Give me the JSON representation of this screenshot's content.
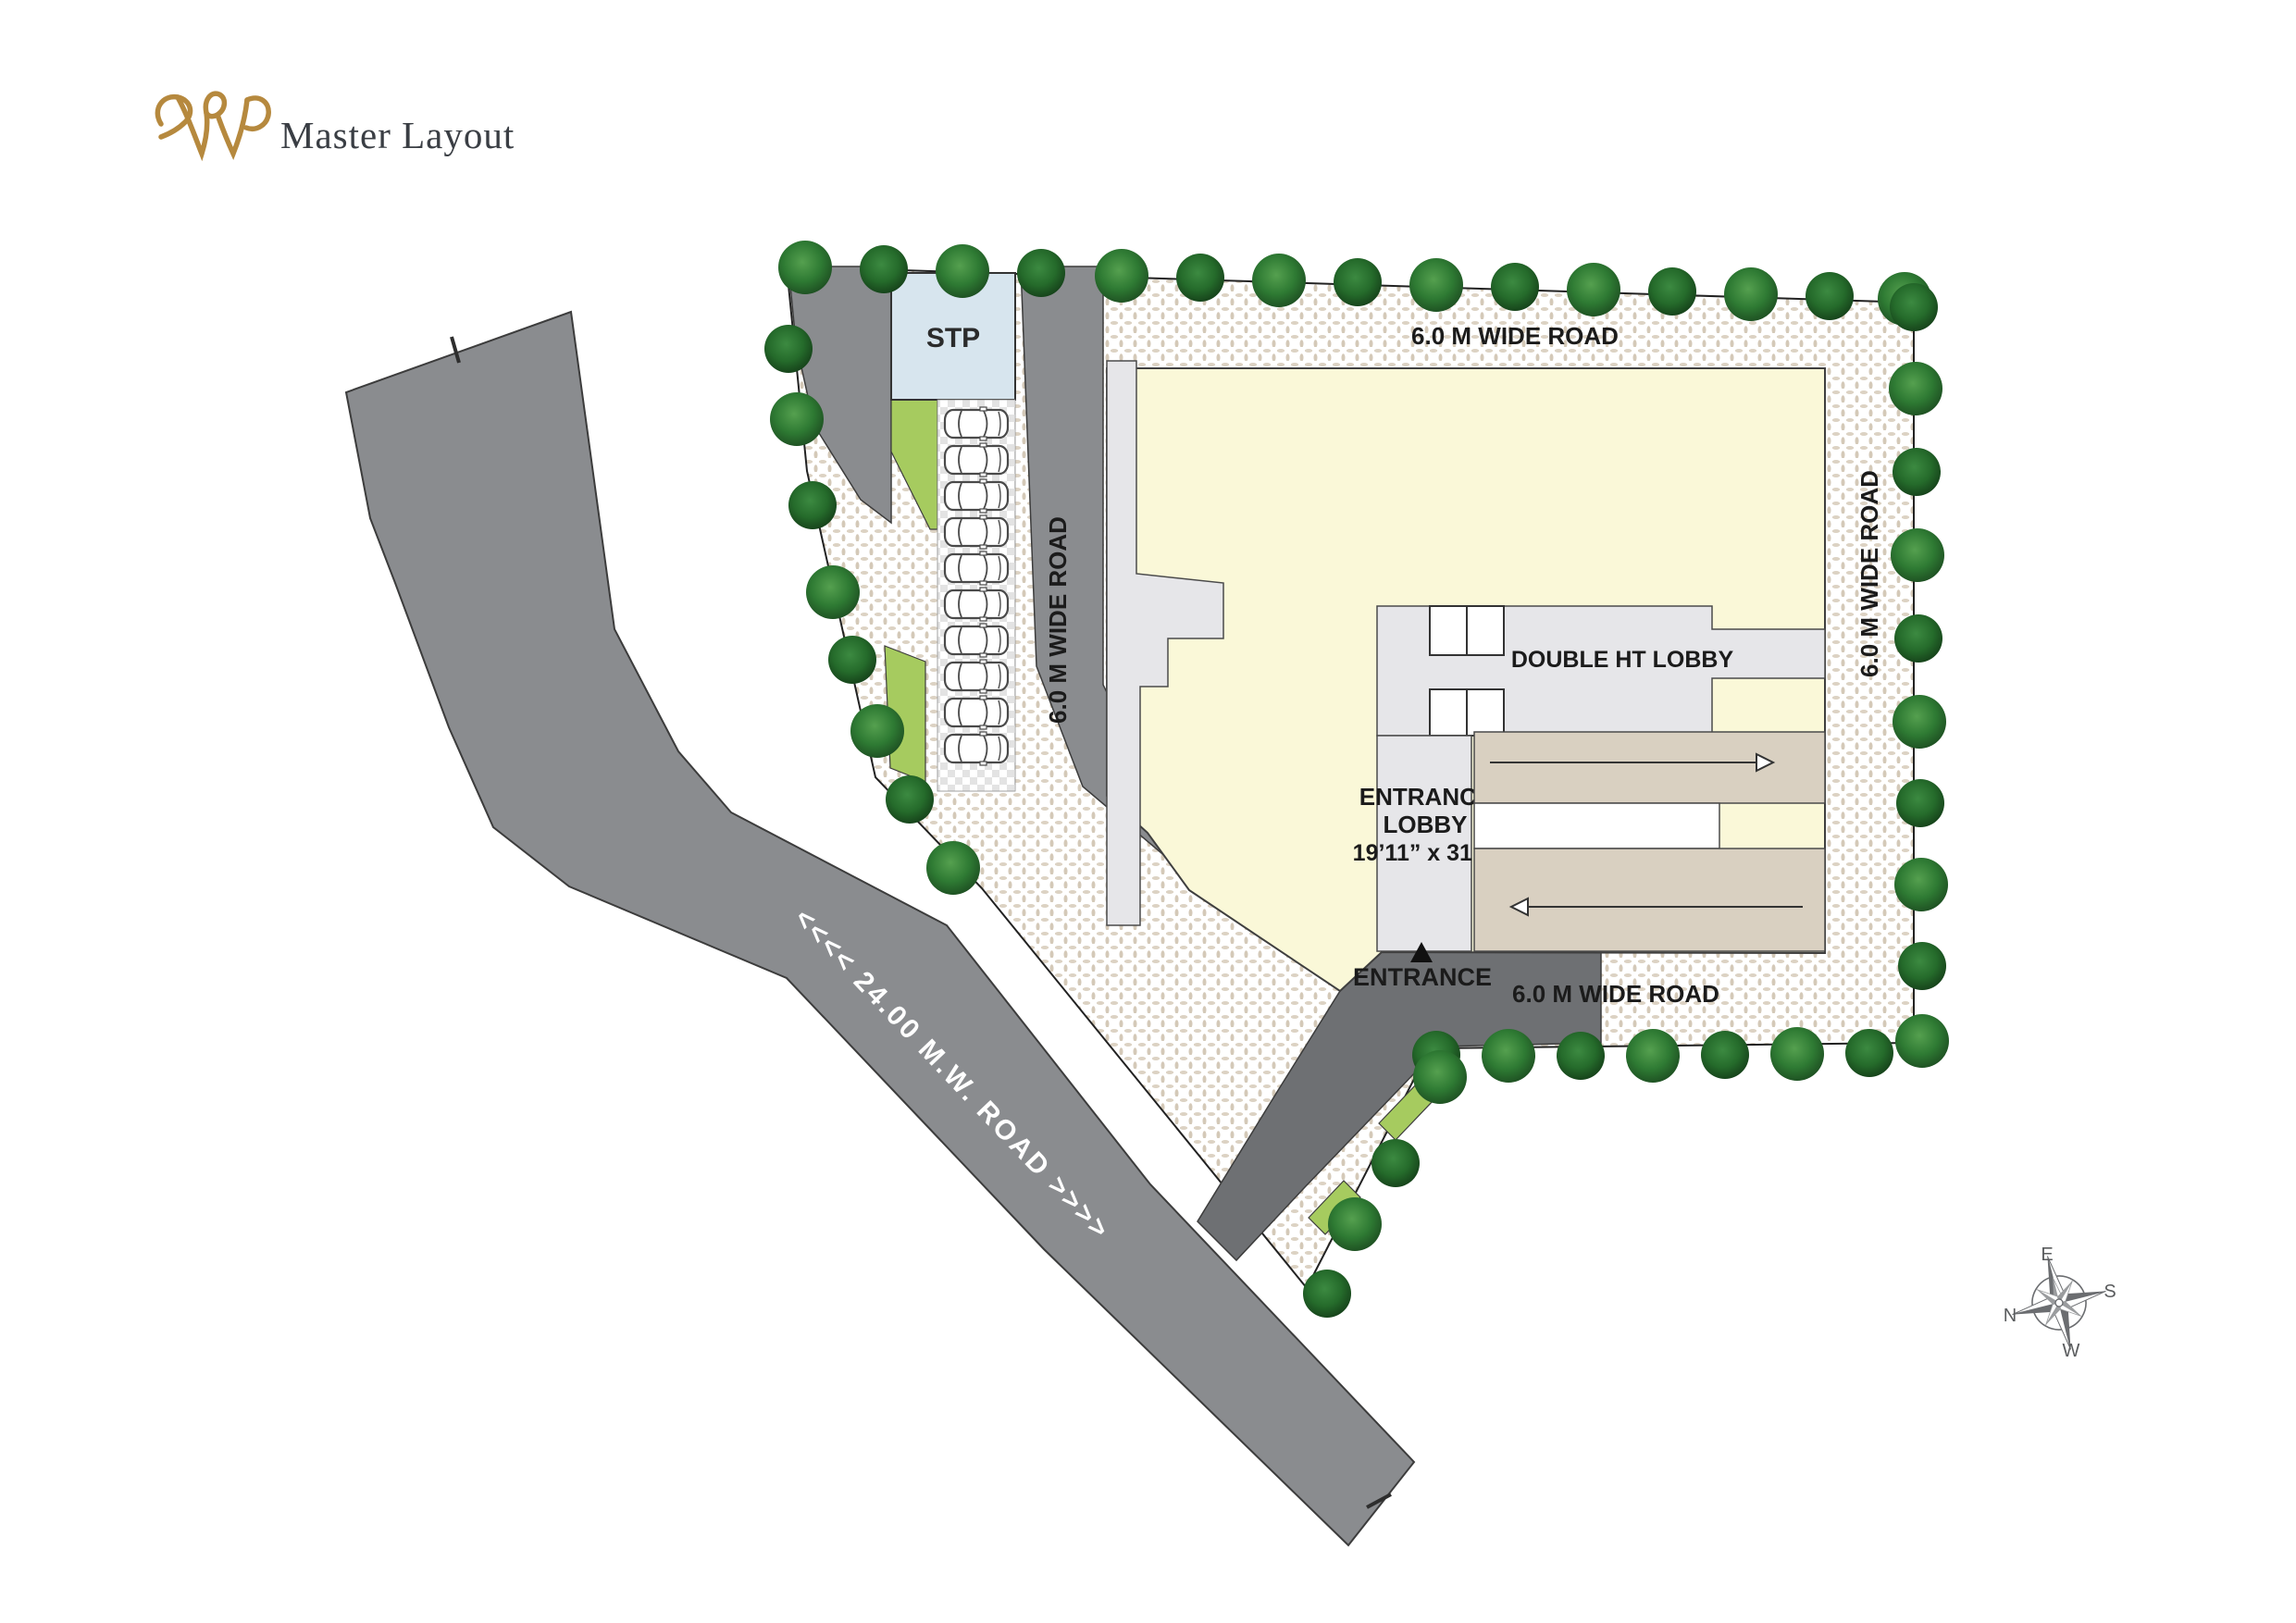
{
  "header": {
    "title": "Master Layout"
  },
  "plan": {
    "stp_label": "STP",
    "roads": {
      "top": "6.0 M WIDE ROAD",
      "left": "6.0 M WIDE ROAD",
      "right": "6.0 M WIDE ROAD",
      "bottom": "6.0 M WIDE ROAD",
      "main": "<<<< 24.00 M.W. ROAD >>>>"
    },
    "building": {
      "double_ht_lobby": "DOUBLE HT LOBBY",
      "entrance_lobby_line1": "ENTRANCE",
      "entrance_lobby_line2": "LOBBY",
      "entrance_lobby_dims": "19’11” x 31’2”",
      "entrance": "ENTRANCE"
    },
    "parking": {
      "spaces": 10
    },
    "compass": {
      "n": "N",
      "e": "E",
      "s": "S",
      "w": "W"
    },
    "colors": {
      "building": "#faf8d8",
      "lobby": "#e6e6e9",
      "ramp": "#d9d0c1",
      "stp": "#d7e5ee",
      "green": "#a6cb5f",
      "road": "#8a8c8f",
      "road_dark": "#6e7073",
      "tree": "#2e6b31",
      "gold": "#b6893e"
    }
  }
}
